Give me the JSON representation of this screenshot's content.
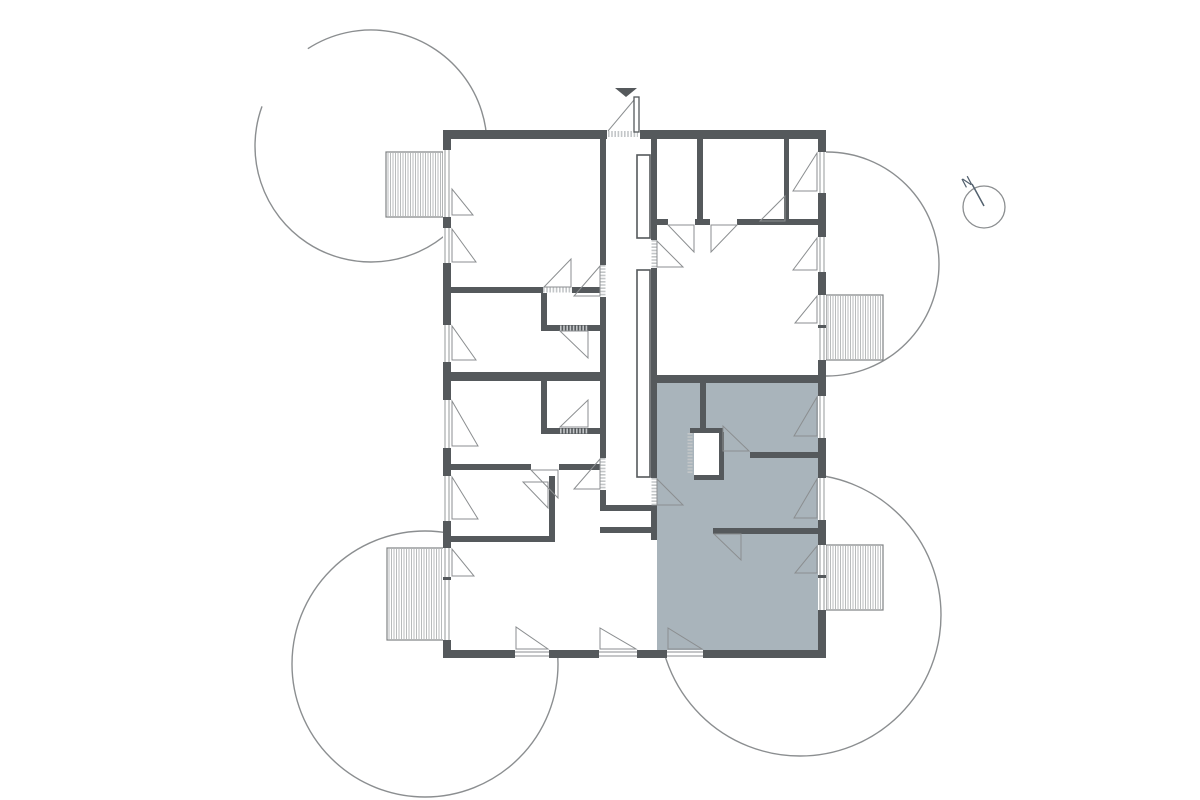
{
  "plan": {
    "background": "#ffffff",
    "canvas": {
      "width": 1200,
      "height": 800
    },
    "colors": {
      "wall": "#55595c",
      "line": "#8b8e90",
      "light_line": "#c3c6c8",
      "hatch": "#9b9ea0",
      "balcony_border": "#7f8284",
      "highlight": "#a9b4bb",
      "north": "#53616e",
      "white": "#ffffff"
    },
    "envelope": [
      443,
      130,
      383,
      528
    ],
    "highlight_room": [
      657,
      383,
      161,
      267
    ],
    "white_patches": [
      [
        694,
        432,
        26,
        44
      ]
    ],
    "trees": [
      {
        "cx": 371,
        "cy": 146,
        "r": 116,
        "gap_start": 200,
        "gap_end": 237
      },
      {
        "cx": 827,
        "cy": 264,
        "r": 112
      },
      {
        "cx": 425,
        "cy": 664,
        "r": 133
      },
      {
        "cx": 800,
        "cy": 615,
        "r": 141
      }
    ],
    "balconies": [
      [
        386,
        152,
        57,
        65
      ],
      [
        826,
        295,
        57,
        65
      ],
      [
        826,
        545,
        57,
        65
      ],
      [
        387,
        548,
        58,
        92
      ]
    ],
    "walls": [
      [
        443,
        130,
        164,
        9
      ],
      [
        640,
        130,
        186,
        9
      ],
      [
        443,
        139,
        8,
        11
      ],
      [
        443,
        217,
        8,
        11
      ],
      [
        443,
        263,
        8,
        62
      ],
      [
        443,
        362,
        8,
        38
      ],
      [
        443,
        448,
        8,
        28
      ],
      [
        443,
        521,
        8,
        27
      ],
      [
        443,
        640,
        8,
        18
      ],
      [
        443,
        577,
        8,
        3
      ],
      [
        818,
        139,
        8,
        13
      ],
      [
        818,
        193,
        8,
        44
      ],
      [
        818,
        272,
        8,
        23
      ],
      [
        818,
        360,
        8,
        36
      ],
      [
        818,
        438,
        8,
        40
      ],
      [
        818,
        520,
        8,
        25
      ],
      [
        818,
        610,
        8,
        48
      ],
      [
        818,
        325,
        8,
        3
      ],
      [
        818,
        575,
        8,
        3
      ],
      [
        443,
        650,
        72,
        8
      ],
      [
        549,
        650,
        50,
        8
      ],
      [
        637,
        650,
        30,
        8
      ],
      [
        703,
        650,
        123,
        8
      ],
      [
        600,
        139,
        6,
        126
      ],
      [
        600,
        297,
        6,
        161
      ],
      [
        600,
        490,
        6,
        15
      ],
      [
        651,
        139,
        6,
        101
      ],
      [
        651,
        268,
        6,
        210
      ],
      [
        651,
        506,
        6,
        34
      ],
      [
        451,
        372,
        149,
        9
      ],
      [
        657,
        375,
        161,
        8
      ],
      [
        451,
        287,
        92,
        6
      ],
      [
        572,
        287,
        28,
        6
      ],
      [
        541,
        293,
        6,
        38
      ],
      [
        541,
        325,
        59,
        6
      ],
      [
        541,
        381,
        6,
        53
      ],
      [
        541,
        428,
        59,
        6
      ],
      [
        451,
        464,
        80,
        6
      ],
      [
        559,
        464,
        41,
        6
      ],
      [
        549,
        476,
        6,
        60
      ],
      [
        451,
        536,
        104,
        6
      ],
      [
        600,
        505,
        57,
        6
      ],
      [
        600,
        527,
        57,
        6
      ],
      [
        697,
        139,
        6,
        86
      ],
      [
        657,
        219,
        11,
        6
      ],
      [
        695,
        219,
        15,
        6
      ],
      [
        737,
        219,
        81,
        6
      ],
      [
        784,
        139,
        5,
        80
      ],
      [
        700,
        383,
        6,
        49
      ],
      [
        690,
        428,
        33,
        5
      ],
      [
        719,
        432,
        5,
        48
      ],
      [
        694,
        475,
        30,
        5
      ],
      [
        750,
        452,
        68,
        6
      ],
      [
        713,
        528,
        105,
        6
      ]
    ],
    "shafts": [
      [
        637,
        155,
        13,
        83
      ],
      [
        637,
        270,
        13,
        207
      ]
    ],
    "windows": [
      [
        443,
        150,
        8,
        67
      ],
      [
        443,
        228,
        8,
        35
      ],
      [
        443,
        325,
        8,
        37
      ],
      [
        443,
        400,
        8,
        48
      ],
      [
        443,
        476,
        8,
        45
      ],
      [
        443,
        548,
        8,
        29
      ],
      [
        443,
        580,
        8,
        60
      ],
      [
        818,
        152,
        8,
        41
      ],
      [
        818,
        237,
        8,
        35
      ],
      [
        818,
        295,
        8,
        30
      ],
      [
        818,
        328,
        8,
        32
      ],
      [
        818,
        396,
        8,
        42
      ],
      [
        818,
        478,
        8,
        42
      ],
      [
        818,
        545,
        8,
        30
      ],
      [
        818,
        578,
        8,
        32
      ],
      [
        515,
        650,
        34,
        8
      ],
      [
        599,
        650,
        38,
        8
      ],
      [
        667,
        650,
        36,
        8
      ]
    ],
    "wedges": [
      [
        452,
        189,
        452,
        215,
        473,
        215
      ],
      [
        452,
        229,
        452,
        262,
        476,
        262
      ],
      [
        452,
        326,
        452,
        360,
        476,
        360
      ],
      [
        452,
        401,
        452,
        446,
        478,
        446
      ],
      [
        452,
        477,
        452,
        519,
        478,
        519
      ],
      [
        452,
        549,
        452,
        576,
        474,
        576
      ],
      [
        817,
        153,
        817,
        191,
        793,
        191
      ],
      [
        817,
        238,
        817,
        270,
        793,
        270
      ],
      [
        817,
        296,
        817,
        323,
        795,
        323
      ],
      [
        817,
        397,
        817,
        436,
        794,
        436
      ],
      [
        817,
        479,
        817,
        518,
        794,
        518
      ],
      [
        817,
        546,
        817,
        573,
        795,
        573
      ],
      [
        548,
        649,
        516,
        649,
        516,
        627
      ],
      [
        636,
        649,
        600,
        649,
        600,
        628
      ],
      [
        702,
        649,
        668,
        649,
        668,
        628
      ],
      [
        600,
        266,
        600,
        296,
        574,
        296
      ],
      [
        600,
        459,
        600,
        489,
        574,
        489
      ],
      [
        657,
        241,
        657,
        267,
        683,
        267
      ],
      [
        657,
        479,
        657,
        505,
        683,
        505
      ],
      [
        571,
        259,
        571,
        287,
        544,
        287
      ],
      [
        588,
        331,
        560,
        331,
        588,
        358
      ],
      [
        588,
        427,
        560,
        427,
        588,
        400
      ],
      [
        558,
        470,
        558,
        498,
        531,
        470
      ],
      [
        548,
        482,
        548,
        508,
        523,
        482
      ],
      [
        694,
        225,
        694,
        252,
        668,
        225
      ],
      [
        711,
        225,
        711,
        252,
        737,
        225
      ],
      [
        785,
        221,
        785,
        196,
        760,
        221
      ],
      [
        723,
        451,
        749,
        451,
        723,
        426
      ],
      [
        741,
        534,
        714,
        534,
        741,
        560
      ]
    ],
    "thresholds": [
      [
        603,
        265,
        603,
        297
      ],
      [
        603,
        458,
        603,
        490
      ],
      [
        654,
        240,
        654,
        268
      ],
      [
        654,
        478,
        654,
        506
      ],
      [
        543,
        290,
        572,
        290
      ],
      [
        560,
        328,
        588,
        328
      ],
      [
        560,
        431,
        588,
        431
      ],
      [
        690,
        433,
        690,
        474
      ]
    ],
    "entrance": {
      "marker": [
        615,
        88,
        637,
        88,
        626,
        97
      ],
      "leaf": [
        634,
        97,
        5,
        35
      ],
      "swing": [
        634,
        100,
        608,
        131
      ],
      "threshold": [
        608,
        134,
        638,
        134
      ]
    },
    "north": {
      "cx": 984,
      "cy": 207,
      "r": 21,
      "needle": [
        984,
        206,
        972,
        184
      ],
      "label": "N",
      "label_x": 969,
      "label_y": 186,
      "label_rot": -28
    }
  }
}
